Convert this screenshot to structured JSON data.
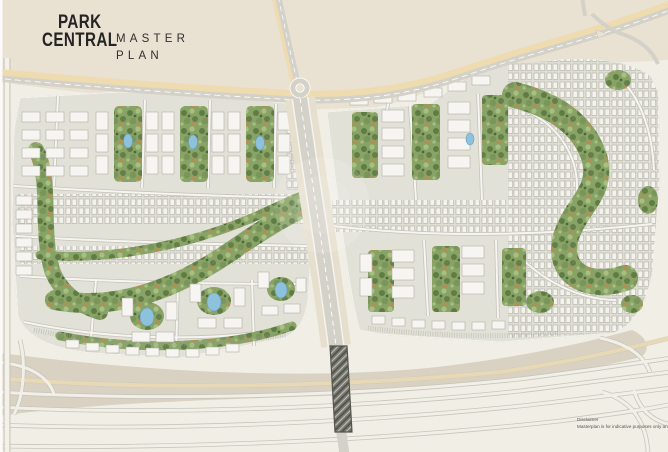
{
  "brand": {
    "line1": "PARK",
    "line2": "CENTRAL"
  },
  "plan_title": {
    "line1": "MASTER",
    "line2": "PLAN"
  },
  "disclaimer": {
    "heading": "Disclaimer",
    "body": "Masterplan is for indicative purposes only an"
  },
  "map": {
    "kind": "residential masterplan site map",
    "districts": [
      {
        "name": "west-district",
        "content": "apartment blocks, townhouse rows, courtyard ponds, central green spine"
      },
      {
        "name": "east-district",
        "content": "apartment clusters, pocket parks, townhouse loops, winding green spine"
      }
    ],
    "features": [
      "desert-land",
      "main-highway",
      "roundabout",
      "north-access-road",
      "central-boulevard",
      "highway-bridge",
      "southern-interchange",
      "green-park-spines",
      "courtyard-ponds",
      "parking-rows",
      "service-road-west-edge"
    ],
    "pond_count": 7,
    "colors": {
      "desert": "#e9e1d2",
      "parcel": "#e2e1d8",
      "road": "#d4d1c8",
      "road_shoulder": "#eedbb0",
      "south_band": "#d9d1c1",
      "greenery": "#7f9c60",
      "green_accent": "#c08a4e",
      "pond": "#8ec2dc",
      "background": "#f1eee6",
      "building": "#f6f5f1",
      "text": "#242424"
    }
  }
}
